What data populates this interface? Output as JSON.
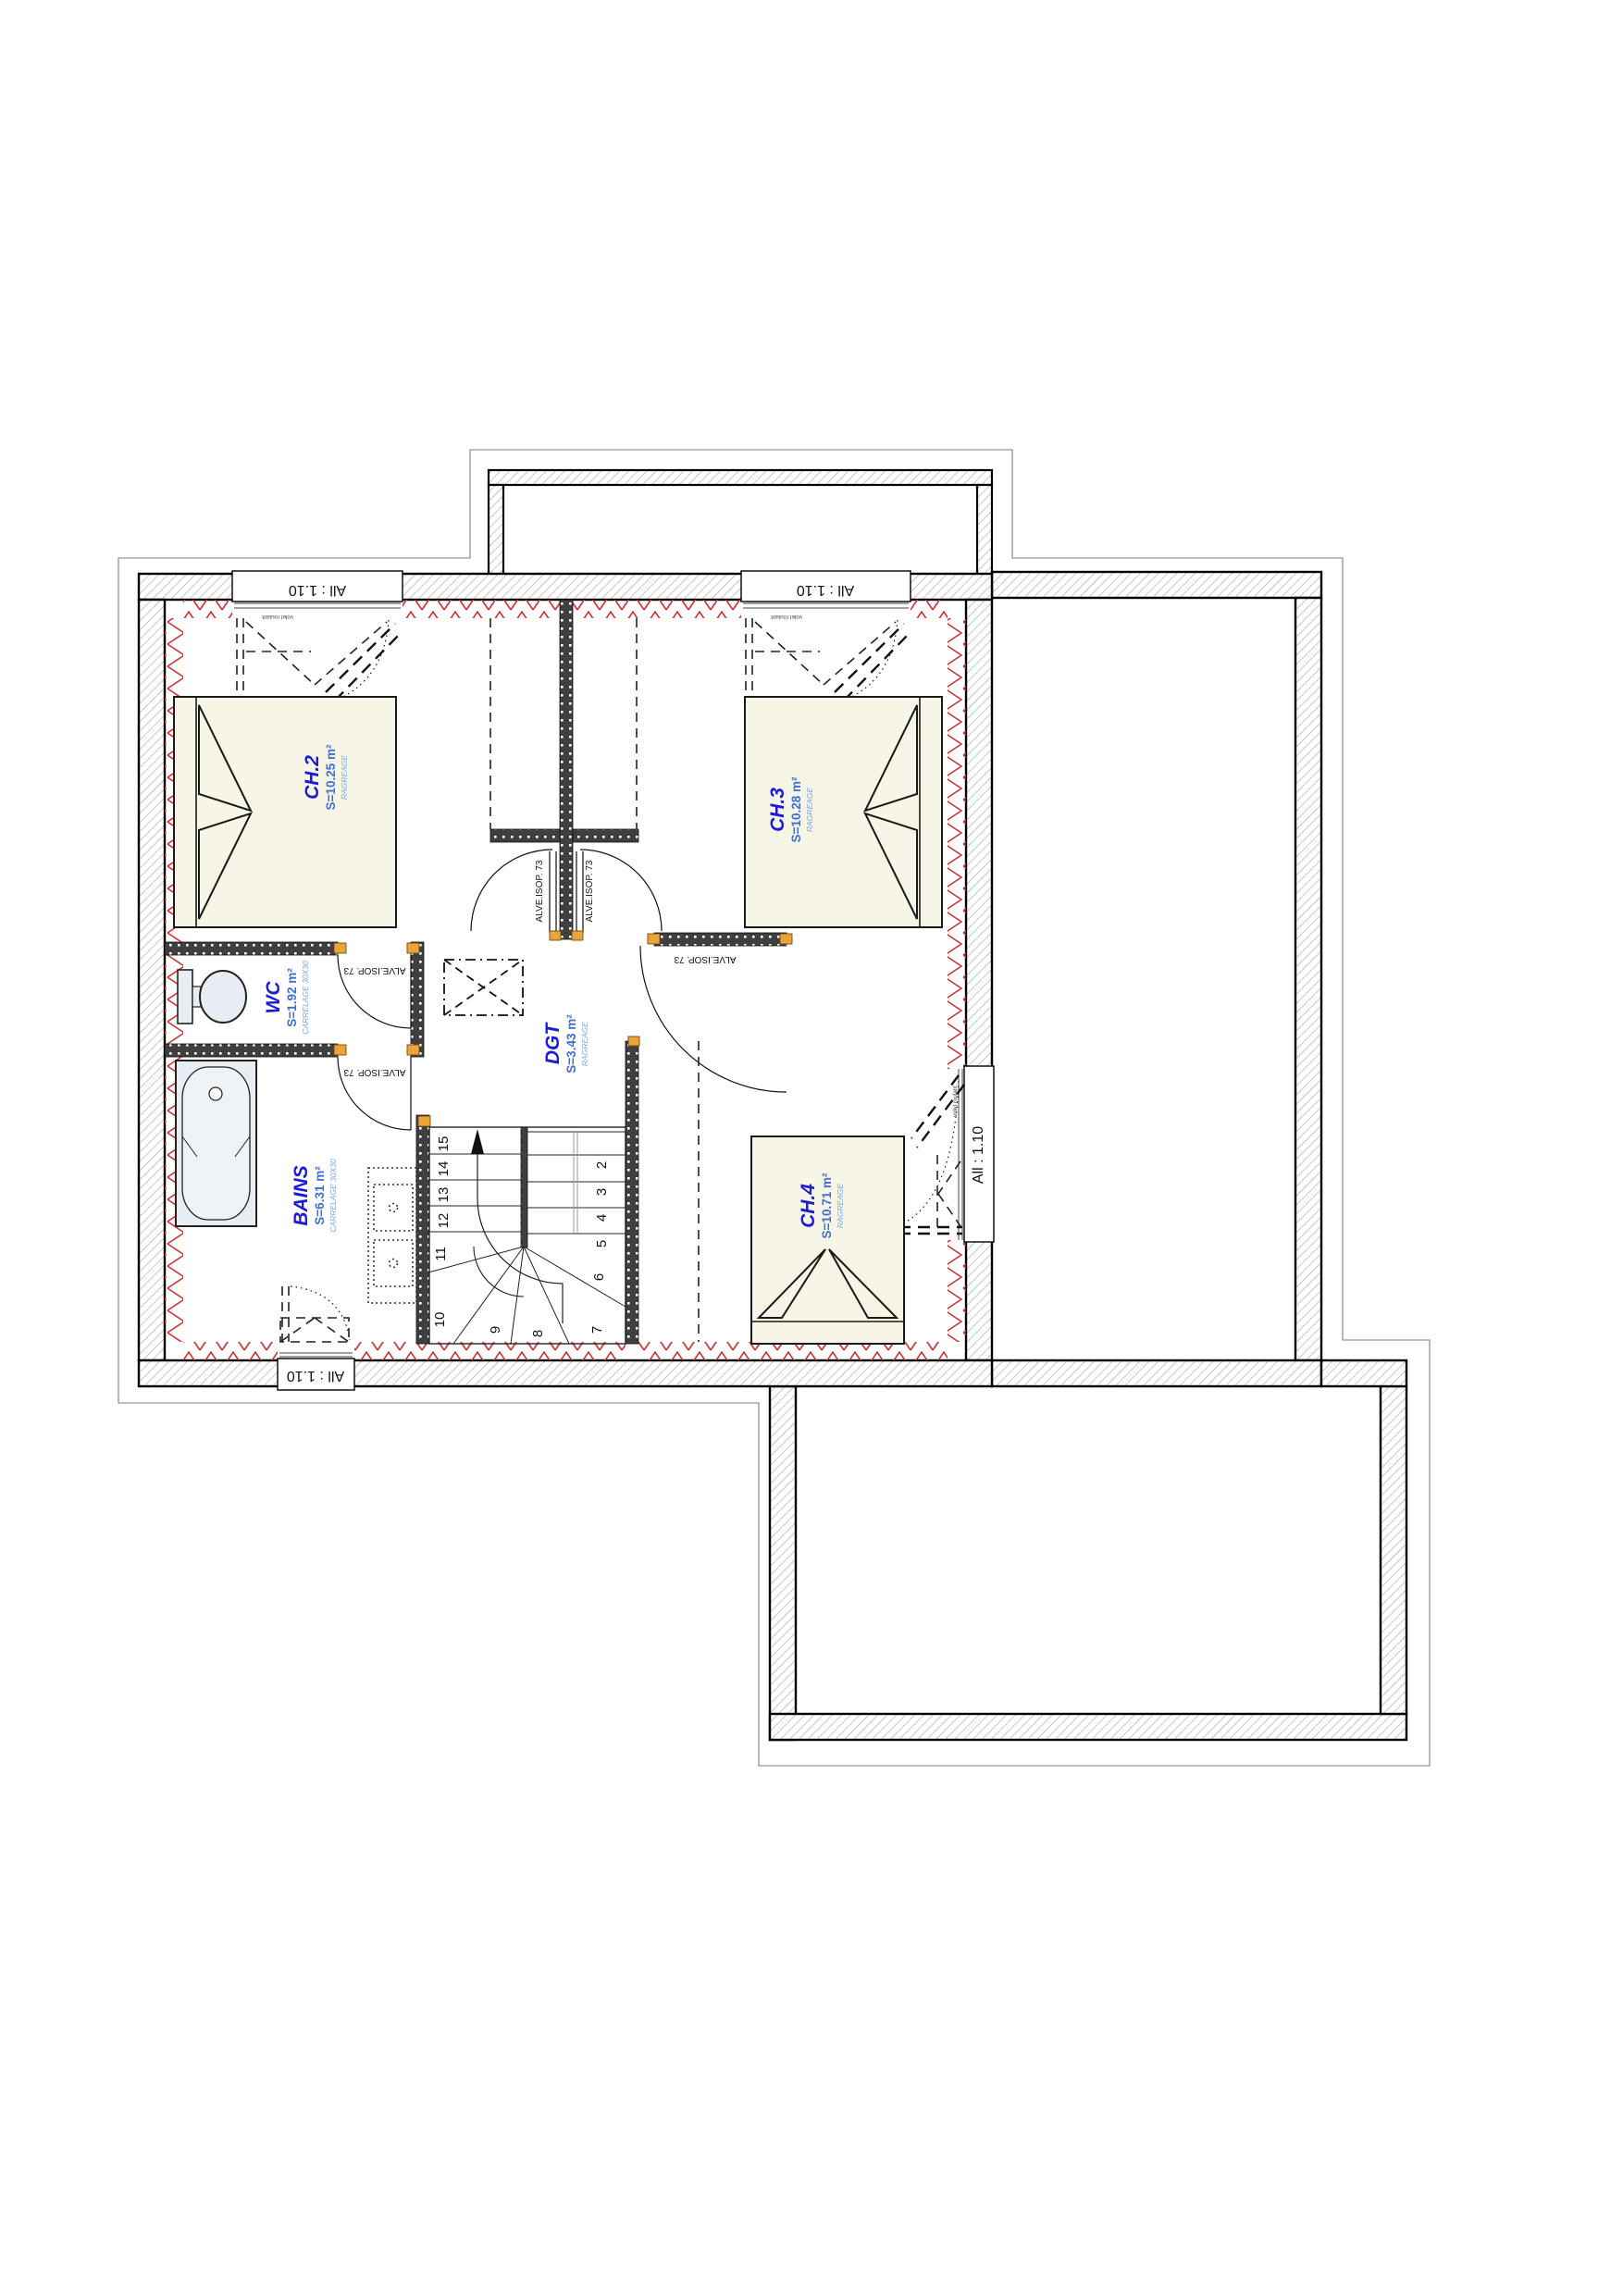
{
  "plan": {
    "rooms": {
      "ch2": {
        "name": "CH.2",
        "area": "S=10.25 m²",
        "finish": "RAGREAGE"
      },
      "ch3": {
        "name": "CH.3",
        "area": "S=10.28 m²",
        "finish": "RAGREAGE"
      },
      "ch4": {
        "name": "CH.4",
        "area": "S=10.71 m²",
        "finish": "RAGREAGE"
      },
      "wc": {
        "name": "WC",
        "area": "S=1.92 m²",
        "finish": "CARRELAGE  30X30"
      },
      "bains": {
        "name": "BAINS",
        "area": "S=6.31 m²",
        "finish": "CARRELAGE  30X30"
      },
      "dgt": {
        "name": "DGT",
        "area": "S=3.43 m²",
        "finish": "RAGREAGE"
      }
    },
    "window_label": "All : 1.10",
    "shutter_note": "volet roulant",
    "door_label": "ALVE.ISOP. 73",
    "stair_steps": [
      "2",
      "3",
      "4",
      "5",
      "6",
      "7",
      "8",
      "9",
      "10",
      "11",
      "12",
      "13",
      "14",
      "15"
    ],
    "colors": {
      "insulation_red": "#d63030",
      "room_label_blue": "#1c1cd8",
      "area_label_blue": "#3a6fd8",
      "finish_label_blue": "#7aa7e8",
      "door_hinge_orange": "#e9a43c",
      "wall_black": "#000000"
    }
  }
}
